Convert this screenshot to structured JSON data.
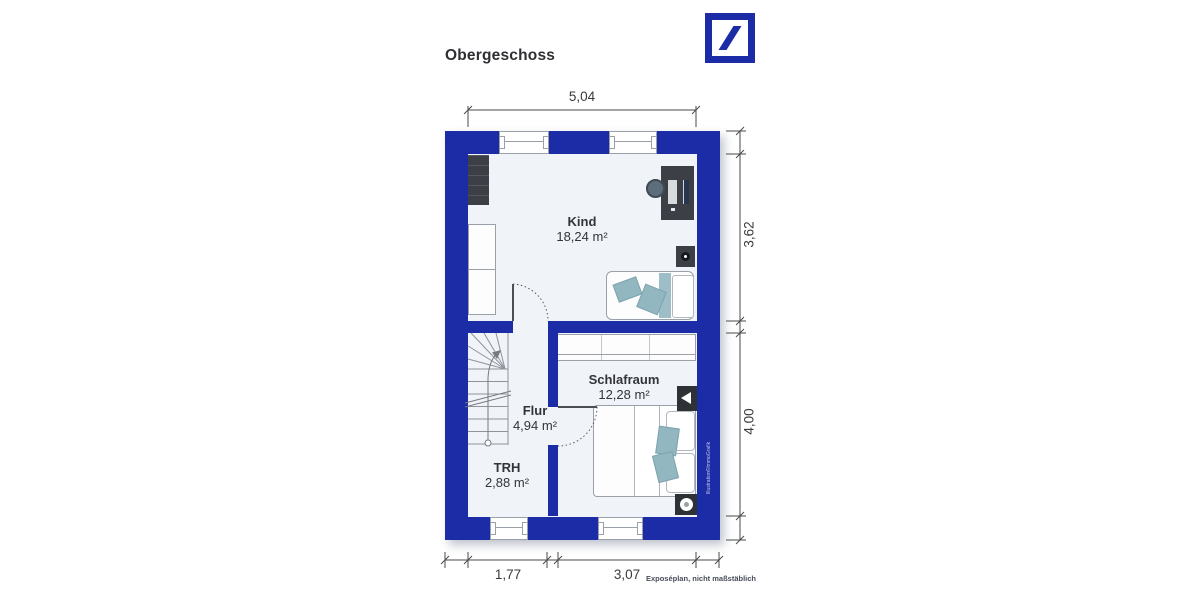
{
  "title": "Obergeschoss",
  "logo": "deutsche-bank-logo",
  "rooms": {
    "kind": {
      "name": "Kind",
      "area": "18,24 m²"
    },
    "schlafraum": {
      "name": "Schlafraum",
      "area": "12,28 m²"
    },
    "flur": {
      "name": "Flur",
      "area": "4,94 m²"
    },
    "trh": {
      "name": "TRH",
      "area": "2,88 m²"
    }
  },
  "dimensions": {
    "top_width": "5,04",
    "right_upper": "3,62",
    "right_lower": "4,00",
    "bottom_left": "1,77",
    "bottom_right": "3,07"
  },
  "footnote": "Exposéplan, nicht maßstäblich",
  "credit": "Illustration©ImmoGrafik",
  "colors": {
    "wall_blue": "#1b2ca6",
    "teal": "#93b7c1",
    "floor": "#f0f4f9"
  }
}
